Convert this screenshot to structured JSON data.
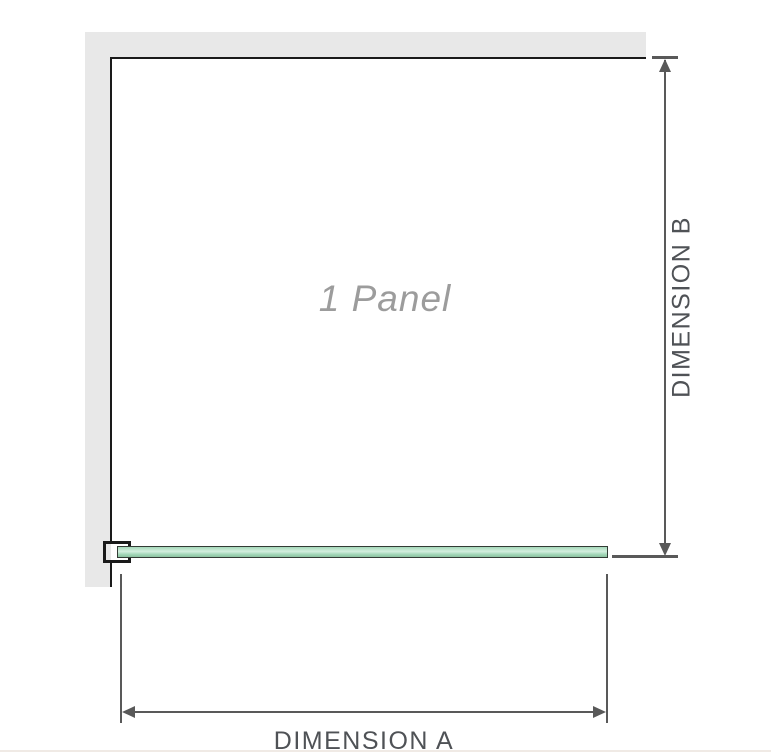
{
  "colors": {
    "wall": "#e8e8e8",
    "panel_outline": "#1a1a1a",
    "dim_line": "#595959",
    "dim_text": "#4f5256",
    "panel_text": "#9c9c9c",
    "glass_fill": "#a5d8ba",
    "glass_highlight": "#d4efdf",
    "glass_shade": "#8cc2a1",
    "glass_border": "#333b35",
    "bottom_rule": "#f0eae5"
  },
  "diagram": {
    "panel_label": "1 Panel",
    "dimension_a_label": "DIMENSION A",
    "dimension_b_label": "DIMENSION B"
  }
}
